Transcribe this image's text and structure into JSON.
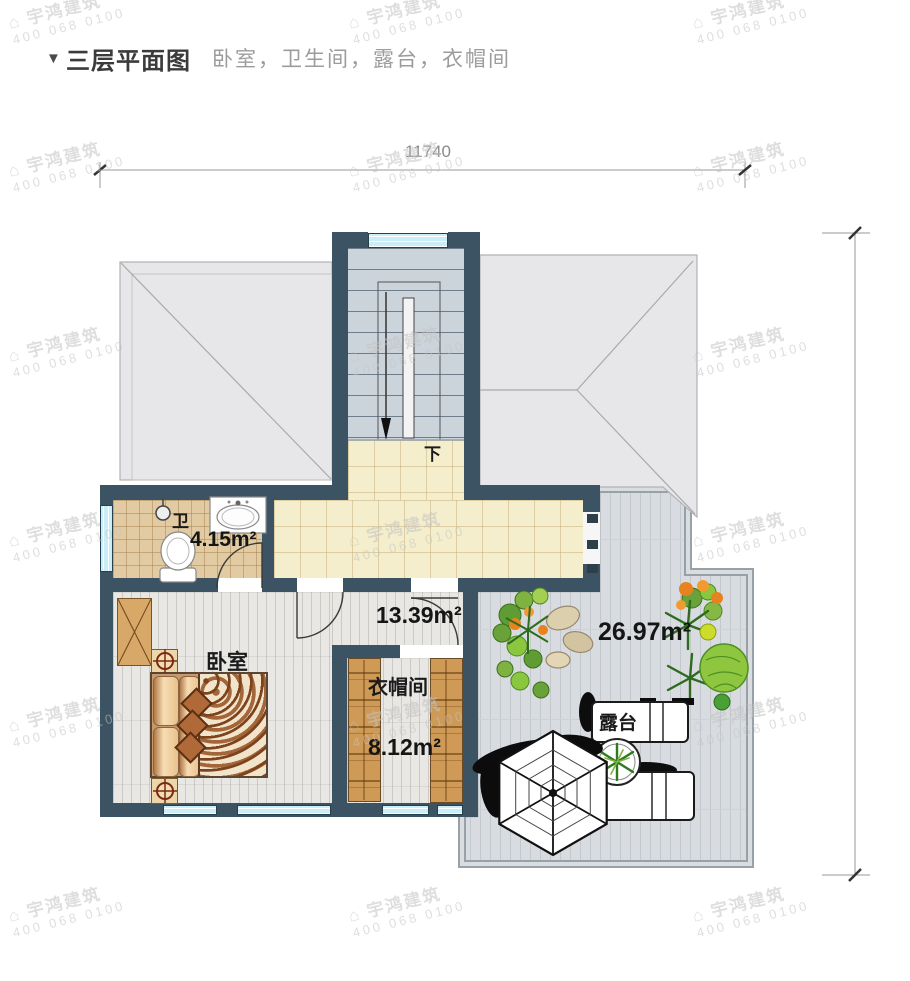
{
  "header": {
    "marker": "▼",
    "title": "三层平面图",
    "subtitle": "卧室，卫生间，露台，衣帽间"
  },
  "dimensions": {
    "top_width": "11740"
  },
  "stairs": {
    "direction_label": "下"
  },
  "rooms": {
    "bathroom": {
      "name": "卫",
      "area": "4.15m²"
    },
    "hall": {
      "area": "13.39m²"
    },
    "bedroom": {
      "name": "卧室"
    },
    "cloakroom": {
      "name": "衣帽间",
      "area": "8.12m²"
    },
    "terrace": {
      "name": "露台",
      "area": "26.97m²"
    }
  },
  "watermark": {
    "logo": "⌂",
    "line1": "宇鸿建筑",
    "line2": "400 068 0100"
  },
  "colors": {
    "wall": "#3b5362",
    "window": "#c9eef8",
    "corridor_floor": "#f4eecd",
    "bathroom_floor": "#e2cba2",
    "plank_floor": "#e8e7e4",
    "stair_floor": "#ccd4db",
    "deck_floor": "#d8dce0",
    "deck_stripe": "#c3c8cc",
    "roof": "#e7e7e9",
    "roof_edge": "#b2b2b5",
    "wardrobe": "#cf9a55",
    "cabinet": "#d8a868",
    "plant_green": "#7fb241",
    "plant_dark": "#2e6b1f",
    "flower_orange": "#e8821e",
    "dim_text": "#8b8b8b",
    "watermark": "#c4c4c4"
  }
}
